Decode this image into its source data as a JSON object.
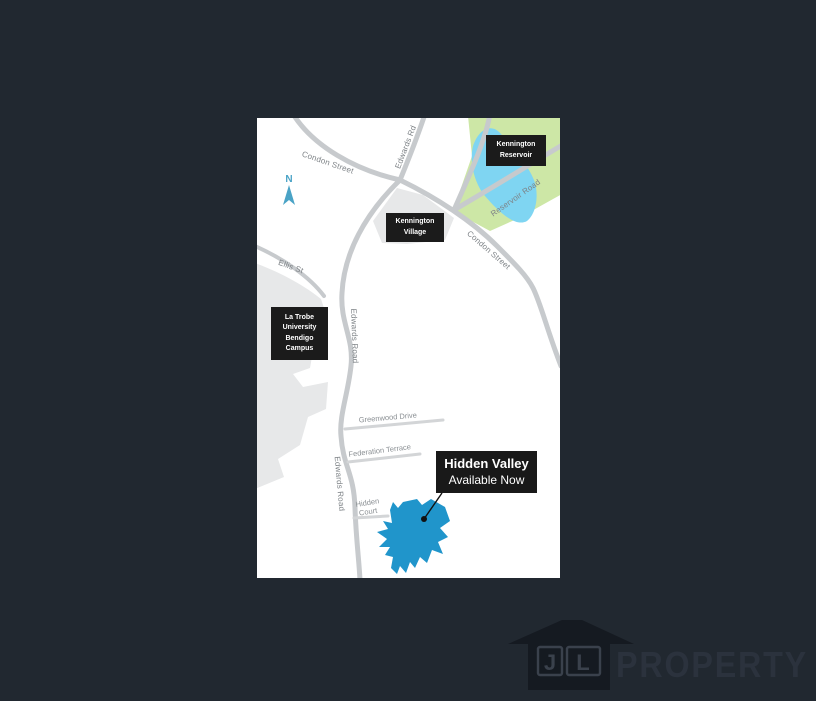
{
  "map": {
    "north_label": "N",
    "streets": {
      "condon_west": "Condon Street",
      "edwards_rd": "Edwards Rd",
      "edwards_road_upper": "Edwards Road",
      "edwards_road_lower": "Edwards Road",
      "ellis": "Ellis St",
      "condon_east": "Condon Street",
      "reservoir_road": "Reservoir Road",
      "greenwood": "Greenwood Drive",
      "federation": "Federation Terrace",
      "hidden_court_line1": "Hidden",
      "hidden_court_line2": "Court"
    },
    "places": {
      "kennington_reservoir": "Kennington\nReservoir",
      "kennington_village": "Kennington\nVillage",
      "la_trobe": "La Trobe\nUniversity\nBendigo\nCampus"
    },
    "callout": {
      "title": "Hidden Valley",
      "subtitle": "Available Now"
    },
    "colors": {
      "page_background": "#212830",
      "map_background": "#ffffff",
      "road": "#c7cacd",
      "road_minor": "#d3d5d7",
      "area_gray": "#e7e8e9",
      "park_green": "#cde7a6",
      "water_blue": "#7fd5f2",
      "estate_blue": "#2095cb",
      "label_box": "#1b1b1b",
      "north_arrow": "#4aa3c6"
    }
  },
  "logo": {
    "letter_j": "J",
    "letter_l": "L",
    "brand": "PROPERTY"
  }
}
